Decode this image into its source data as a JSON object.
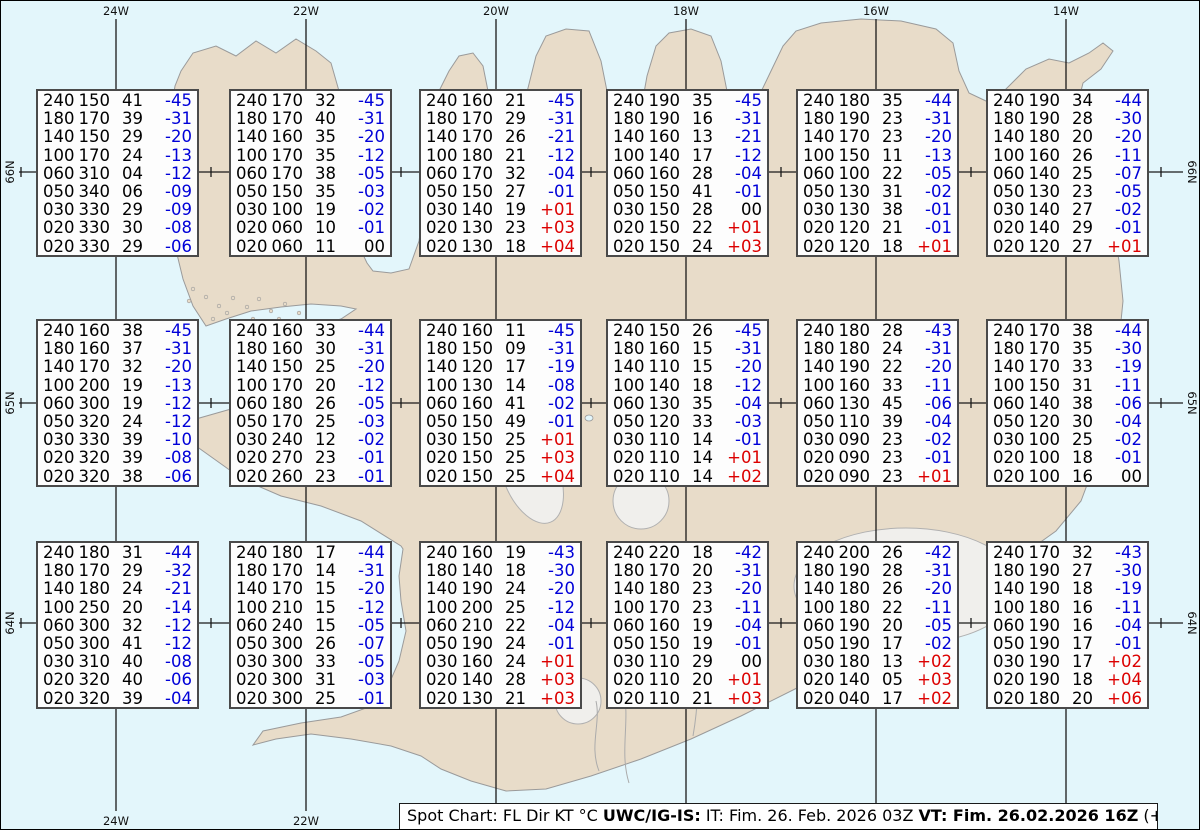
{
  "title": "Spot Chart Iceland",
  "map": {
    "sea_color": "#e3f6fb",
    "land_color": "#e8dcc9",
    "coast_color": "#9a9a9a",
    "glacier_fill": "#f0efec",
    "glacier_stroke": "#b0b0b0",
    "grid_color": "#1a1a1a",
    "meridians": [
      {
        "label": "24W",
        "x": 115,
        "bottom_label": true
      },
      {
        "label": "22W",
        "x": 305,
        "bottom_label": true
      },
      {
        "label": "20W",
        "x": 495,
        "bottom_label": false
      },
      {
        "label": "18W",
        "x": 685,
        "bottom_label": false
      },
      {
        "label": "16W",
        "x": 875,
        "bottom_label": false
      },
      {
        "label": "14W",
        "x": 1065,
        "bottom_label": false
      }
    ],
    "parallels": [
      {
        "label": "66N",
        "y": 171
      },
      {
        "label": "65N",
        "y": 402
      },
      {
        "label": "64N",
        "y": 622
      }
    ],
    "tick_xs": [
      20,
      210,
      400,
      590,
      780,
      970,
      1160
    ]
  },
  "legend_units": {
    "columns": "FL Dir KT °C"
  },
  "text_colors": {
    "negative_temp": "#0000d8",
    "positive_temp": "#dc0000",
    "default": "#000000"
  },
  "boxes": {
    "cols_x": [
      35,
      228,
      418,
      605,
      795,
      985
    ],
    "rows_y": [
      88,
      318,
      540
    ],
    "width": 163,
    "height": 168,
    "grid": [
      [
        [
          [
            "240",
            "150",
            "41",
            "-45"
          ],
          [
            "180",
            "170",
            "39",
            "-31"
          ],
          [
            "140",
            "150",
            "29",
            "-20"
          ],
          [
            "100",
            "170",
            "24",
            "-13"
          ],
          [
            "060",
            "310",
            "04",
            "-12"
          ],
          [
            "050",
            "340",
            "06",
            "-09"
          ],
          [
            "030",
            "330",
            "29",
            "-09"
          ],
          [
            "020",
            "330",
            "30",
            "-08"
          ],
          [
            "020",
            "330",
            "29",
            "-06"
          ]
        ],
        [
          [
            "240",
            "170",
            "32",
            "-45"
          ],
          [
            "180",
            "170",
            "40",
            "-31"
          ],
          [
            "140",
            "160",
            "35",
            "-20"
          ],
          [
            "100",
            "170",
            "35",
            "-12"
          ],
          [
            "060",
            "170",
            "38",
            "-05"
          ],
          [
            "050",
            "150",
            "35",
            "-03"
          ],
          [
            "030",
            "100",
            "19",
            "-02"
          ],
          [
            "020",
            "060",
            "10",
            "-01"
          ],
          [
            "020",
            "060",
            "11",
            "00"
          ]
        ],
        [
          [
            "240",
            "160",
            "21",
            "-45"
          ],
          [
            "180",
            "170",
            "29",
            "-31"
          ],
          [
            "140",
            "170",
            "26",
            "-21"
          ],
          [
            "100",
            "180",
            "21",
            "-12"
          ],
          [
            "060",
            "170",
            "32",
            "-04"
          ],
          [
            "050",
            "150",
            "27",
            "-01"
          ],
          [
            "030",
            "140",
            "19",
            "+01"
          ],
          [
            "020",
            "130",
            "23",
            "+03"
          ],
          [
            "020",
            "130",
            "18",
            "+04"
          ]
        ],
        [
          [
            "240",
            "190",
            "35",
            "-45"
          ],
          [
            "180",
            "190",
            "16",
            "-31"
          ],
          [
            "140",
            "160",
            "13",
            "-21"
          ],
          [
            "100",
            "140",
            "17",
            "-12"
          ],
          [
            "060",
            "160",
            "28",
            "-04"
          ],
          [
            "050",
            "150",
            "41",
            "-01"
          ],
          [
            "030",
            "150",
            "28",
            "00"
          ],
          [
            "020",
            "150",
            "22",
            "+01"
          ],
          [
            "020",
            "150",
            "24",
            "+03"
          ]
        ],
        [
          [
            "240",
            "180",
            "35",
            "-44"
          ],
          [
            "180",
            "190",
            "23",
            "-31"
          ],
          [
            "140",
            "170",
            "23",
            "-20"
          ],
          [
            "100",
            "150",
            "11",
            "-13"
          ],
          [
            "060",
            "100",
            "22",
            "-05"
          ],
          [
            "050",
            "130",
            "31",
            "-02"
          ],
          [
            "030",
            "130",
            "38",
            "-01"
          ],
          [
            "020",
            "120",
            "21",
            "-01"
          ],
          [
            "020",
            "120",
            "18",
            "+01"
          ]
        ],
        [
          [
            "240",
            "190",
            "34",
            "-44"
          ],
          [
            "180",
            "190",
            "28",
            "-30"
          ],
          [
            "140",
            "180",
            "20",
            "-20"
          ],
          [
            "100",
            "160",
            "26",
            "-11"
          ],
          [
            "060",
            "140",
            "25",
            "-07"
          ],
          [
            "050",
            "130",
            "23",
            "-05"
          ],
          [
            "030",
            "140",
            "27",
            "-02"
          ],
          [
            "020",
            "140",
            "29",
            "-01"
          ],
          [
            "020",
            "120",
            "27",
            "+01"
          ]
        ]
      ],
      [
        [
          [
            "240",
            "160",
            "38",
            "-45"
          ],
          [
            "180",
            "160",
            "37",
            "-31"
          ],
          [
            "140",
            "170",
            "32",
            "-20"
          ],
          [
            "100",
            "200",
            "19",
            "-13"
          ],
          [
            "060",
            "300",
            "19",
            "-12"
          ],
          [
            "050",
            "320",
            "24",
            "-12"
          ],
          [
            "030",
            "330",
            "39",
            "-10"
          ],
          [
            "020",
            "320",
            "39",
            "-08"
          ],
          [
            "020",
            "320",
            "38",
            "-06"
          ]
        ],
        [
          [
            "240",
            "160",
            "33",
            "-44"
          ],
          [
            "180",
            "160",
            "30",
            "-31"
          ],
          [
            "140",
            "150",
            "25",
            "-20"
          ],
          [
            "100",
            "170",
            "20",
            "-12"
          ],
          [
            "060",
            "180",
            "26",
            "-05"
          ],
          [
            "050",
            "170",
            "25",
            "-03"
          ],
          [
            "030",
            "240",
            "12",
            "-02"
          ],
          [
            "020",
            "270",
            "23",
            "-01"
          ],
          [
            "020",
            "260",
            "23",
            "-01"
          ]
        ],
        [
          [
            "240",
            "160",
            "11",
            "-45"
          ],
          [
            "180",
            "150",
            "09",
            "-31"
          ],
          [
            "140",
            "120",
            "17",
            "-19"
          ],
          [
            "100",
            "130",
            "14",
            "-08"
          ],
          [
            "060",
            "160",
            "41",
            "-02"
          ],
          [
            "050",
            "150",
            "49",
            "-01"
          ],
          [
            "030",
            "150",
            "25",
            "+01"
          ],
          [
            "020",
            "150",
            "25",
            "+03"
          ],
          [
            "020",
            "150",
            "25",
            "+04"
          ]
        ],
        [
          [
            "240",
            "150",
            "26",
            "-45"
          ],
          [
            "180",
            "160",
            "15",
            "-31"
          ],
          [
            "140",
            "110",
            "15",
            "-20"
          ],
          [
            "100",
            "140",
            "18",
            "-12"
          ],
          [
            "060",
            "130",
            "35",
            "-04"
          ],
          [
            "050",
            "120",
            "33",
            "-03"
          ],
          [
            "030",
            "110",
            "14",
            "-01"
          ],
          [
            "020",
            "110",
            "14",
            "+01"
          ],
          [
            "020",
            "110",
            "14",
            "+02"
          ]
        ],
        [
          [
            "240",
            "180",
            "28",
            "-43"
          ],
          [
            "180",
            "180",
            "24",
            "-31"
          ],
          [
            "140",
            "190",
            "22",
            "-20"
          ],
          [
            "100",
            "160",
            "33",
            "-11"
          ],
          [
            "060",
            "130",
            "45",
            "-06"
          ],
          [
            "050",
            "110",
            "39",
            "-04"
          ],
          [
            "030",
            "090",
            "23",
            "-02"
          ],
          [
            "020",
            "090",
            "23",
            "-01"
          ],
          [
            "020",
            "090",
            "23",
            "+01"
          ]
        ],
        [
          [
            "240",
            "170",
            "38",
            "-44"
          ],
          [
            "180",
            "170",
            "35",
            "-30"
          ],
          [
            "140",
            "170",
            "33",
            "-19"
          ],
          [
            "100",
            "150",
            "31",
            "-11"
          ],
          [
            "060",
            "140",
            "38",
            "-06"
          ],
          [
            "050",
            "120",
            "30",
            "-04"
          ],
          [
            "030",
            "100",
            "25",
            "-02"
          ],
          [
            "020",
            "100",
            "18",
            "-01"
          ],
          [
            "020",
            "100",
            "16",
            "00"
          ]
        ]
      ],
      [
        [
          [
            "240",
            "180",
            "31",
            "-44"
          ],
          [
            "180",
            "170",
            "29",
            "-32"
          ],
          [
            "140",
            "180",
            "24",
            "-21"
          ],
          [
            "100",
            "250",
            "20",
            "-14"
          ],
          [
            "060",
            "300",
            "32",
            "-12"
          ],
          [
            "050",
            "300",
            "41",
            "-12"
          ],
          [
            "030",
            "310",
            "40",
            "-08"
          ],
          [
            "020",
            "320",
            "40",
            "-06"
          ],
          [
            "020",
            "320",
            "39",
            "-04"
          ]
        ],
        [
          [
            "240",
            "180",
            "17",
            "-44"
          ],
          [
            "180",
            "170",
            "14",
            "-31"
          ],
          [
            "140",
            "170",
            "15",
            "-20"
          ],
          [
            "100",
            "210",
            "15",
            "-12"
          ],
          [
            "060",
            "240",
            "15",
            "-05"
          ],
          [
            "050",
            "300",
            "26",
            "-07"
          ],
          [
            "030",
            "300",
            "33",
            "-05"
          ],
          [
            "020",
            "300",
            "31",
            "-03"
          ],
          [
            "020",
            "300",
            "25",
            "-01"
          ]
        ],
        [
          [
            "240",
            "160",
            "19",
            "-43"
          ],
          [
            "180",
            "140",
            "18",
            "-30"
          ],
          [
            "140",
            "190",
            "24",
            "-20"
          ],
          [
            "100",
            "200",
            "25",
            "-12"
          ],
          [
            "060",
            "210",
            "22",
            "-04"
          ],
          [
            "050",
            "190",
            "24",
            "-01"
          ],
          [
            "030",
            "160",
            "24",
            "+01"
          ],
          [
            "020",
            "140",
            "28",
            "+03"
          ],
          [
            "020",
            "130",
            "21",
            "+03"
          ]
        ],
        [
          [
            "240",
            "220",
            "18",
            "-42"
          ],
          [
            "180",
            "170",
            "20",
            "-31"
          ],
          [
            "140",
            "180",
            "23",
            "-20"
          ],
          [
            "100",
            "170",
            "23",
            "-11"
          ],
          [
            "060",
            "160",
            "19",
            "-04"
          ],
          [
            "050",
            "150",
            "19",
            "-01"
          ],
          [
            "030",
            "110",
            "29",
            "00"
          ],
          [
            "020",
            "110",
            "20",
            "+01"
          ],
          [
            "020",
            "110",
            "21",
            "+03"
          ]
        ],
        [
          [
            "240",
            "200",
            "26",
            "-42"
          ],
          [
            "180",
            "190",
            "28",
            "-31"
          ],
          [
            "140",
            "180",
            "26",
            "-20"
          ],
          [
            "100",
            "180",
            "22",
            "-11"
          ],
          [
            "060",
            "190",
            "20",
            "-05"
          ],
          [
            "050",
            "190",
            "17",
            "-02"
          ],
          [
            "030",
            "180",
            "13",
            "+02"
          ],
          [
            "020",
            "140",
            "05",
            "+03"
          ],
          [
            "020",
            "040",
            "17",
            "+02"
          ]
        ],
        [
          [
            "240",
            "170",
            "32",
            "-43"
          ],
          [
            "180",
            "190",
            "27",
            "-30"
          ],
          [
            "140",
            "190",
            "18",
            "-19"
          ],
          [
            "100",
            "180",
            "16",
            "-11"
          ],
          [
            "060",
            "190",
            "16",
            "-04"
          ],
          [
            "050",
            "190",
            "17",
            "-01"
          ],
          [
            "030",
            "190",
            "17",
            "+02"
          ],
          [
            "020",
            "190",
            "18",
            "+04"
          ],
          [
            "020",
            "180",
            "20",
            "+06"
          ]
        ]
      ]
    ]
  },
  "caption": {
    "segments": [
      {
        "text": "Spot Chart: FL Dir KT °C ",
        "bold": false
      },
      {
        "text": "UWC/IG-IS:",
        "bold": true
      },
      {
        "text": " IT: Fim. 26. Feb. 2026 03Z ",
        "bold": false
      },
      {
        "text": "VT: Fim. 26.02.2026 16Z",
        "bold": true
      },
      {
        "text": " (+13 h)",
        "bold": false
      }
    ]
  }
}
